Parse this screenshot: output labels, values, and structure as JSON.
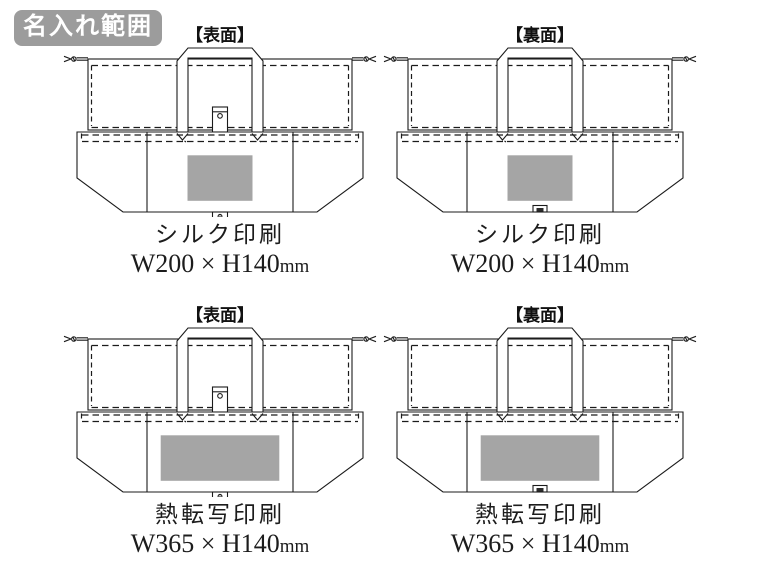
{
  "badge": {
    "label": "名入れ範囲",
    "bg": "#9c9c9c"
  },
  "colors": {
    "print_area": "#a5a5a5",
    "line": "#1b1b1b"
  },
  "cells": [
    {
      "side_label": "【表面】",
      "side": "front",
      "method": "シルク印刷",
      "size_label": "W200 × H140",
      "unit": "mm",
      "print_mm": {
        "w": 200,
        "h": 140
      }
    },
    {
      "side_label": "【裏面】",
      "side": "back",
      "method": "シルク印刷",
      "size_label": "W200 × H140",
      "unit": "mm",
      "print_mm": {
        "w": 200,
        "h": 140
      }
    },
    {
      "side_label": "【表面】",
      "side": "front",
      "method": "熱転写印刷",
      "size_label": "W365 × H140",
      "unit": "mm",
      "print_mm": {
        "w": 365,
        "h": 140
      }
    },
    {
      "side_label": "【裏面】",
      "side": "back",
      "method": "熱転写印刷",
      "size_label": "W365 × H140",
      "unit": "mm",
      "print_mm": {
        "w": 365,
        "h": 140
      }
    }
  ]
}
